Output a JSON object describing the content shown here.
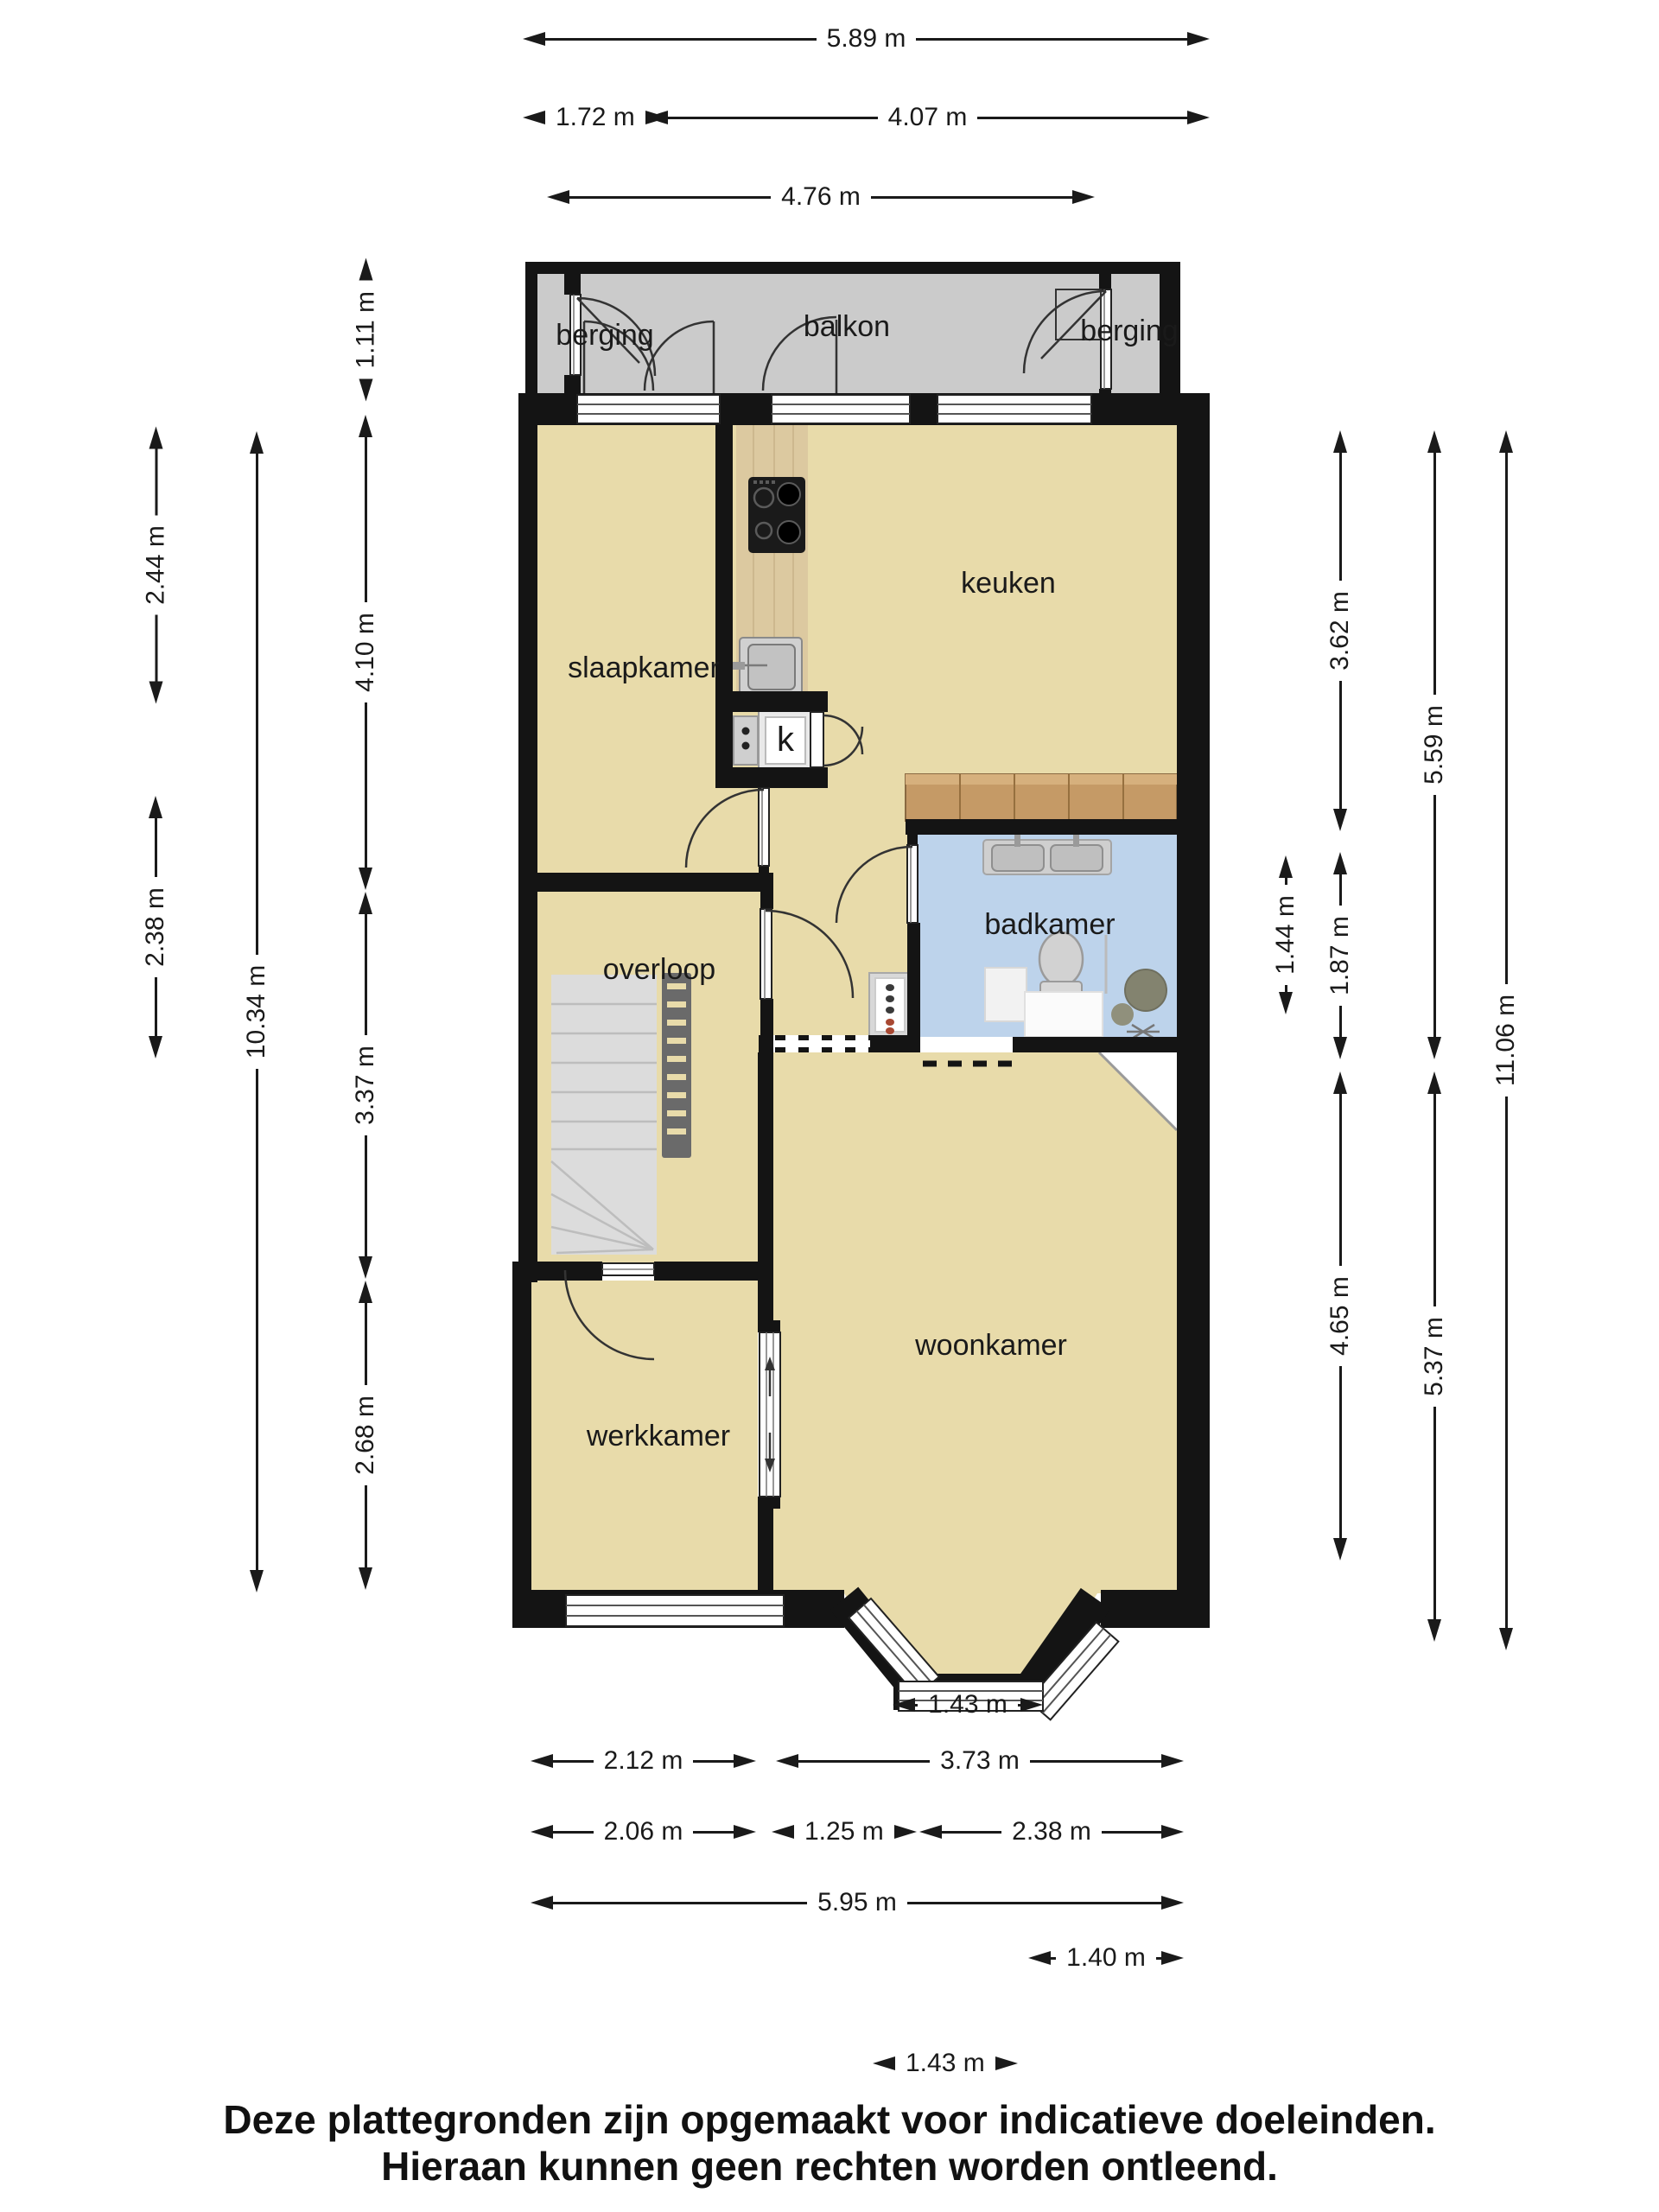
{
  "rooms": [
    {
      "label": "berging"
    },
    {
      "label": "balkon"
    },
    {
      "label": "berging"
    },
    {
      "label": "slaapkamer"
    },
    {
      "label": "keuken"
    },
    {
      "label": "badkamer"
    },
    {
      "label": "overloop"
    },
    {
      "label": "woonkamer"
    },
    {
      "label": "werkkamer"
    },
    {
      "label": "k"
    }
  ],
  "dimensions": {
    "top": [
      {
        "label": "5.89 m"
      },
      {
        "label": "1.72 m"
      },
      {
        "label": "4.07 m"
      },
      {
        "label": "4.76 m"
      }
    ],
    "bottom": [
      {
        "label": "1.43 m"
      },
      {
        "label": "2.12 m"
      },
      {
        "label": "3.73 m"
      },
      {
        "label": "2.06 m"
      },
      {
        "label": "1.25 m"
      },
      {
        "label": "2.38 m"
      },
      {
        "label": "5.95 m"
      },
      {
        "label": "1.40 m"
      },
      {
        "label": "1.43 m"
      }
    ],
    "left": [
      {
        "label": "1.11 m"
      },
      {
        "label": "2.44 m"
      },
      {
        "label": "4.10 m"
      },
      {
        "label": "2.38 m"
      },
      {
        "label": "10.34 m"
      },
      {
        "label": "3.37 m"
      },
      {
        "label": "2.68 m"
      }
    ],
    "right": [
      {
        "label": "3.62 m"
      },
      {
        "label": "5.59 m"
      },
      {
        "label": "1.44 m"
      },
      {
        "label": "1.87 m"
      },
      {
        "label": "11.06 m"
      },
      {
        "label": "4.65 m"
      },
      {
        "label": "5.37 m"
      }
    ]
  },
  "footer": {
    "line1": "Deze plattegronden zijn opgemaakt voor indicatieve doeleinden.",
    "line2": "Hieraan kunnen geen rechten worden ontleend."
  },
  "colors": {
    "wall": "#141414",
    "floor": "#e8dbaa",
    "balcony": "#cbcbcb",
    "bathroom": "#bdd3eb",
    "counter_wood": "#dcc9a0",
    "cabinet_wood": "#c59a66",
    "stairs": "#dcdcdc"
  }
}
